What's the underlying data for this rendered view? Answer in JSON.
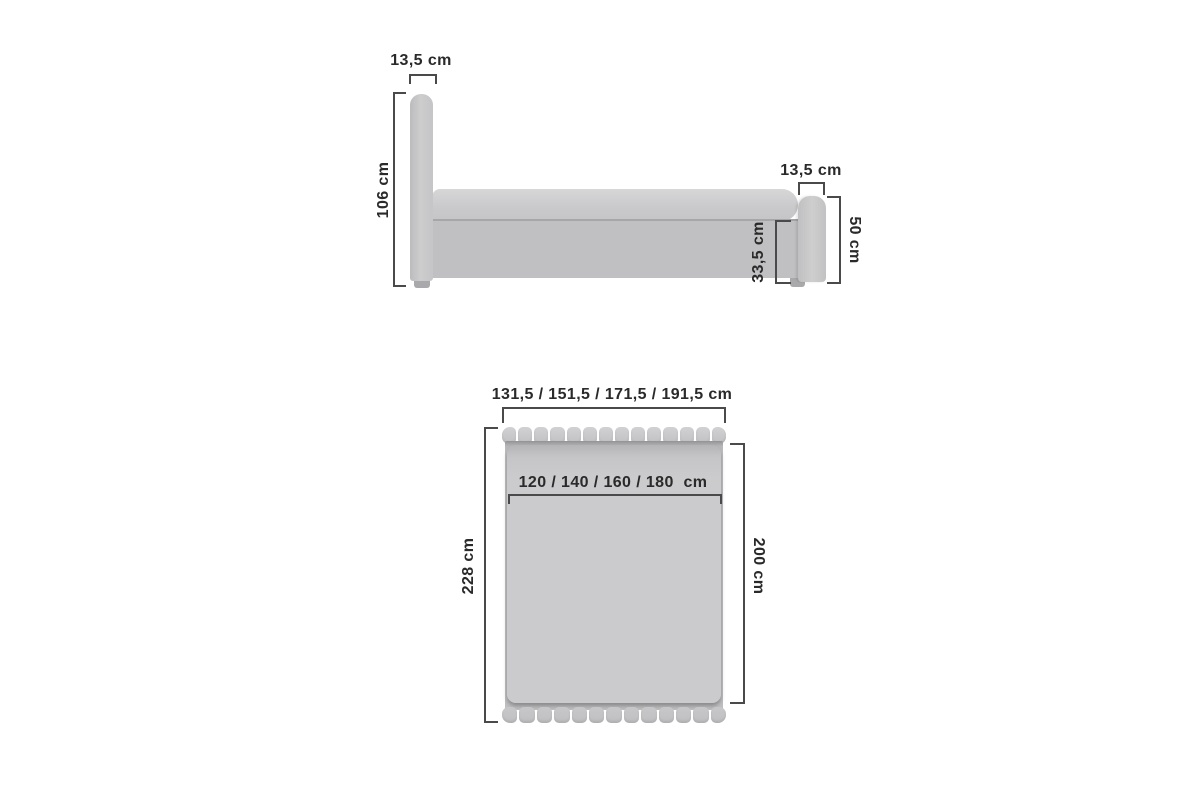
{
  "page": {
    "background": "#ffffff",
    "description": "Bed dimension diagram: side elevation (top) and top plan view (bottom)"
  },
  "colors": {
    "upholstery_light": "#cbcbcd",
    "upholstery_mid": "#c0c0c2",
    "upholstery_dark": "#a9a9ab",
    "dimension_line": "#4a4a4a",
    "label_text": "#2a2a2a"
  },
  "side_view": {
    "name": "bed-side-elevation",
    "headboard_width_label": "13,5 cm",
    "total_height_label": "106 cm",
    "footboard_width_label": "13,5 cm",
    "footboard_height_label": "50 cm",
    "frame_height_label": "33,5 cm"
  },
  "top_view": {
    "name": "bed-top-plan",
    "overall_width_label": "131,5 / 151,5 / 171,5 / 191,5 cm",
    "mattress_width_label": "120 / 140 / 160 / 180  cm",
    "total_length_label": "228 cm",
    "mattress_length_label": "200 cm",
    "headboard_segments": 14,
    "footboard_segments": 13
  }
}
